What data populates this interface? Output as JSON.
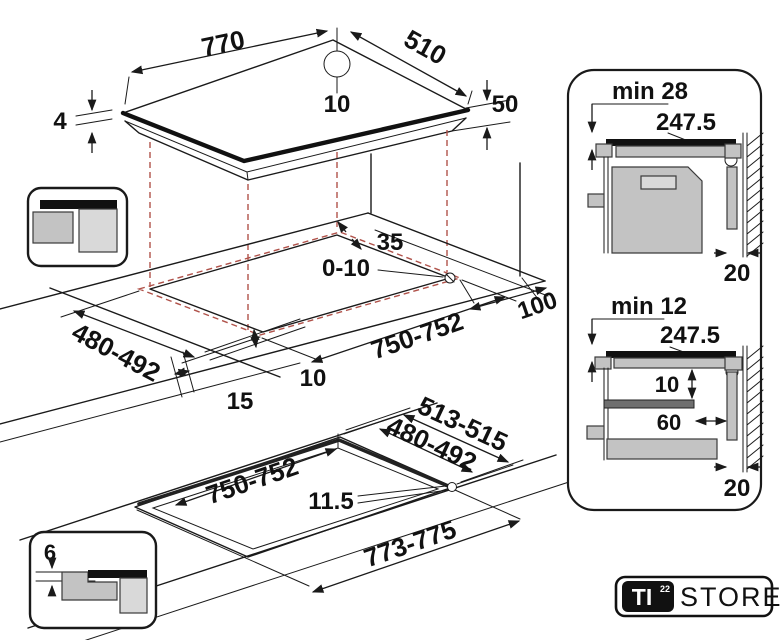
{
  "hob_top_view": {
    "width": "770",
    "depth": "510",
    "hole_to_edge": "10",
    "glass_height": "4",
    "box_height": "50"
  },
  "worktop_cutout_view": {
    "rear_gap": "35",
    "hole_play": "0-10",
    "cutout_depth": "480-492",
    "cutout_width": "750-752",
    "wall_clearance": "100",
    "edge_gap": "10",
    "side_gap": "15"
  },
  "flush_mount_view": {
    "recess_depth": "513-515",
    "cutout_depth": "480-492",
    "cutout_width": "750-752",
    "corner_radius": "11.5",
    "recess_width": "773-775"
  },
  "flush_mount_icon": {
    "rebate_depth": "6"
  },
  "oven_section": {
    "min_clearance": "min 28",
    "cable_length": "247.5",
    "wall_gap": "20"
  },
  "drawer_section": {
    "min_clearance": "min 12",
    "cable_length": "247.5",
    "panel_gap": "10",
    "panel_depth": "60",
    "wall_gap": "20"
  },
  "logo": {
    "mark": "TI",
    "mark_sup": "22",
    "store": "STORE"
  },
  "colors": {
    "line": "#1a1a1a",
    "projection_red": "#b0524a",
    "fill_light": "#d9d9d9",
    "fill_mid": "#c3c3c3",
    "fill_dark": "#6f6f6f"
  }
}
